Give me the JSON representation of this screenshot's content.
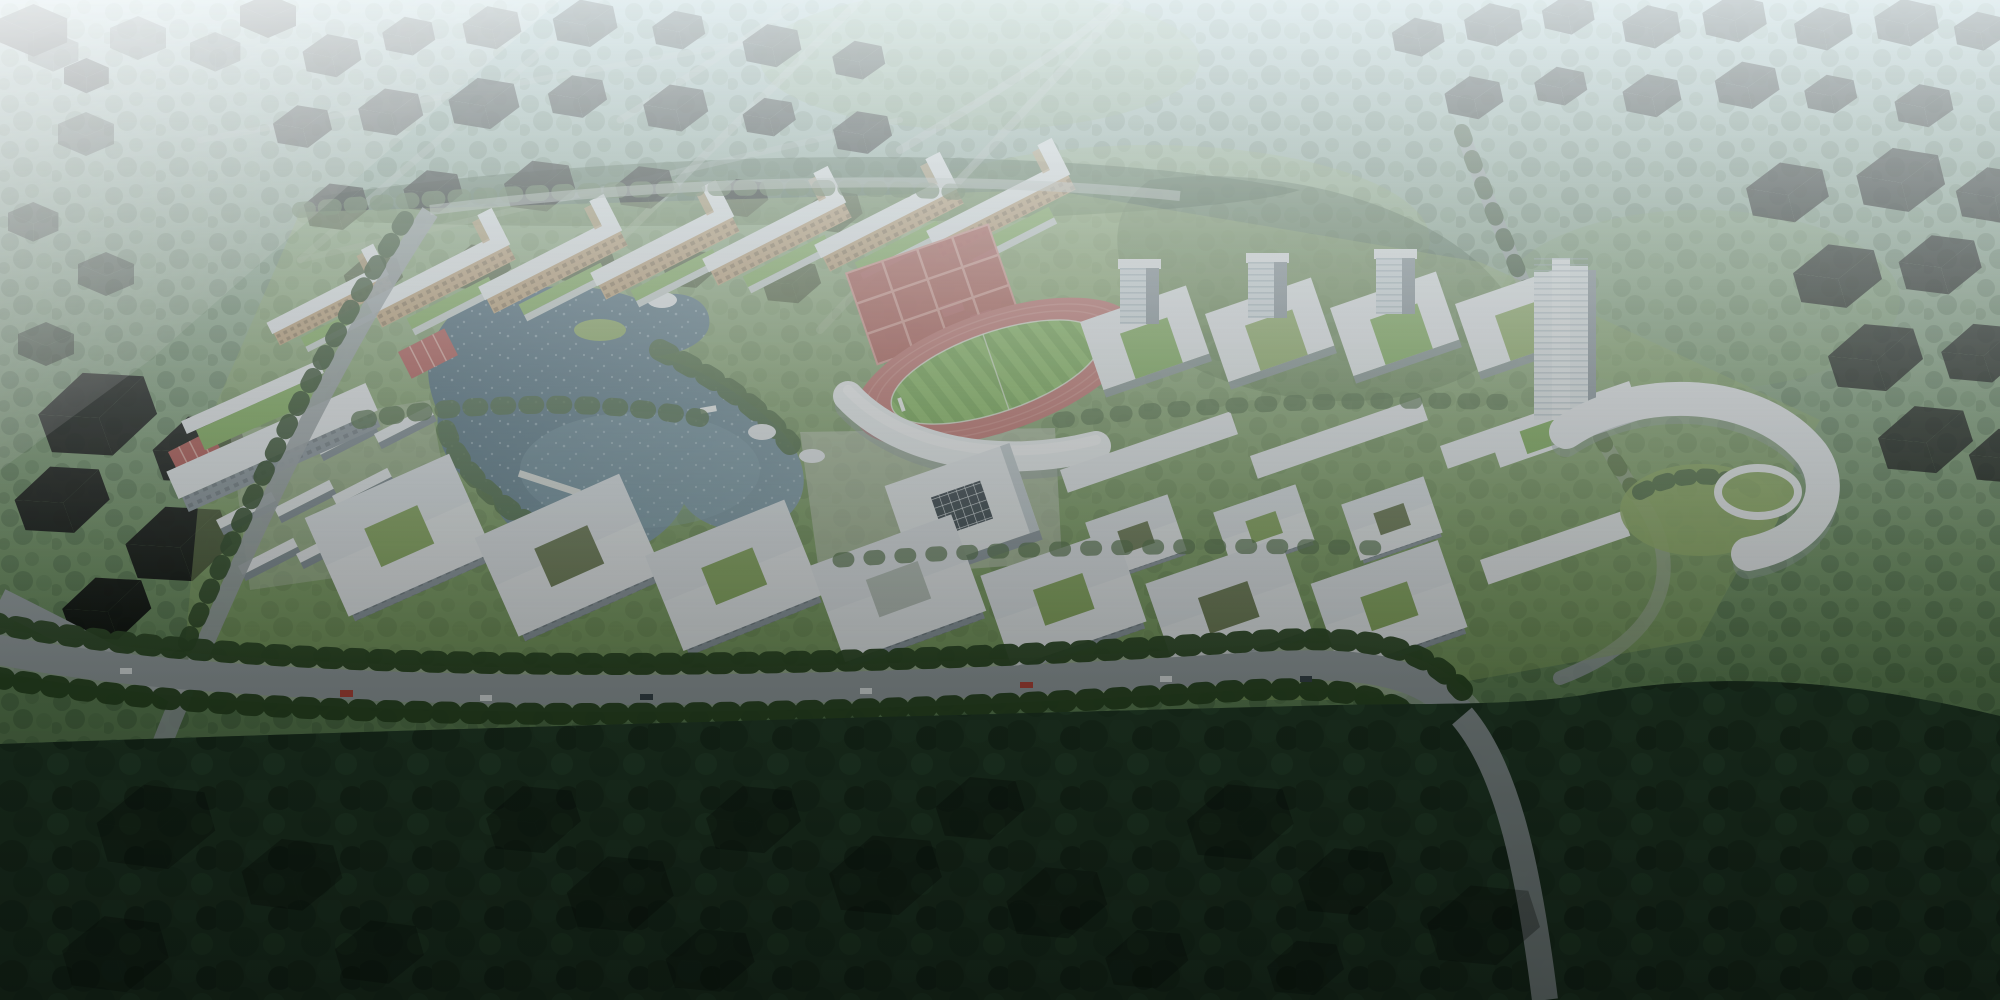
{
  "scene": {
    "title": "Campus masterplan aerial rendering",
    "description": "High-oblique bird's-eye architectural rendering of a lakeside university campus surrounded by tropical forest: a row of tan dormitory slabs, white courtyard teaching buildings, an athletics stadium with red running track, red sports courts, a stepped landmark tower, a curved gateway building with circular garden, and a palm-lined boulevard. Hazy untextured city massing blocks fade into the distance; dark foreground forest holds translucent future-phase building outlines.",
    "view": "aerial bird's-eye, looking across a flat green plain",
    "lighting": "hazy daylight, light beam from upper left, haze strongest at the horizon",
    "visible_text": "none"
  },
  "palette": {
    "haze_top": "#bdd3da",
    "haze_mid": "#a7c3c6",
    "terrain_upper": "#8aa88a",
    "terrain_mid": "#6e9260",
    "terrain_lower": "#46653f",
    "forest_top": "#2c4a2e",
    "forest_bottom": "#142417",
    "canopy_dark": "#2a452b",
    "canopy_mid": "#3c5a38",
    "canopy_light": "#4e6c42",
    "palm_green": "#27421f",
    "lawn": "#8fae62",
    "meadow": "#7fa268",
    "plaza": "#c8cdc2",
    "lake_deep": "#3e5d70",
    "lake_light": "#85a2af",
    "sparkle": "#dcecf4",
    "roof_white": "#eef1f4",
    "roof_shade": "#d4dde2",
    "facade_dark": "#8b969e",
    "dorm_facade": "#c2a176",
    "green_roof": "#7fae57",
    "track_red": "#c4706b",
    "lane_line": "#d99089",
    "pitch_green": "#74a94e",
    "pitch_light": "#86bb5c",
    "court_red": "#b5534f",
    "road_asphalt": "#99a1a5",
    "road_light": "#c4cac9",
    "ctx_top": "#b7c6d1",
    "ctx_left": "#97a8b5",
    "ctx_right": "#8495a3",
    "ctx_dark_top": "#5f6d76",
    "ctx_dark_left": "#39444c",
    "ctx_dark_right": "#2e373e",
    "ghost_top": "#cfdce2",
    "ghost_side": "#aebfc9",
    "skylight_dark": "#39444c",
    "car_red": "#b8443a",
    "car_white": "#e8ecee",
    "car_dark": "#37424a",
    "beam_light": "#eef6f8"
  },
  "campus": {
    "lake": {
      "name": "central lake",
      "features": [
        "green islet",
        "boardwalk pier",
        "small white boat",
        "white shoreline pavilions"
      ]
    },
    "stadium": {
      "name": "athletics stadium",
      "track": "red oval running track",
      "pitch": "green football field with two goals",
      "grandstand": "curved white canopy stand"
    },
    "sports_courts": {
      "name": "red tennis and basketball court grid",
      "count_visible": 12
    },
    "dormitories": {
      "name": "dormitory slabs",
      "count_visible": 7,
      "roof": "white",
      "facade": "warm tan with balcony grid",
      "annex_roofs": "planted green"
    },
    "west_housing": {
      "name": "low housing bars",
      "count_visible": 12,
      "courts": "two red basketball courts"
    },
    "academic_buildings": {
      "name": "white courtyard teaching buildings",
      "count_visible": 9,
      "courtyards": "planted green"
    },
    "labs": {
      "name": "U-shaped lab blocks",
      "count_visible": 4,
      "mid_rise_blocks": 3
    },
    "conference_hall": {
      "name": "assembly hall",
      "roof": "white flat roof with dark grid skylight"
    },
    "tower": {
      "name": "landmark high-rise",
      "storeys_approx": 20,
      "crown": "stepped white crown"
    },
    "gateway": {
      "name": "curved gateway building",
      "features": [
        "circular garden",
        "white ring pavilion"
      ]
    },
    "boulevard": {
      "name": "palm-lined boulevard",
      "traffic": "scattered cars"
    }
  },
  "context": {
    "background": "hazy untextured city massing blocks among tree-lined avenues",
    "foreground": "dark dense forest with translucent future-phase building outlines",
    "roads": "diagonal tree-lined avenues crossing the plain"
  }
}
